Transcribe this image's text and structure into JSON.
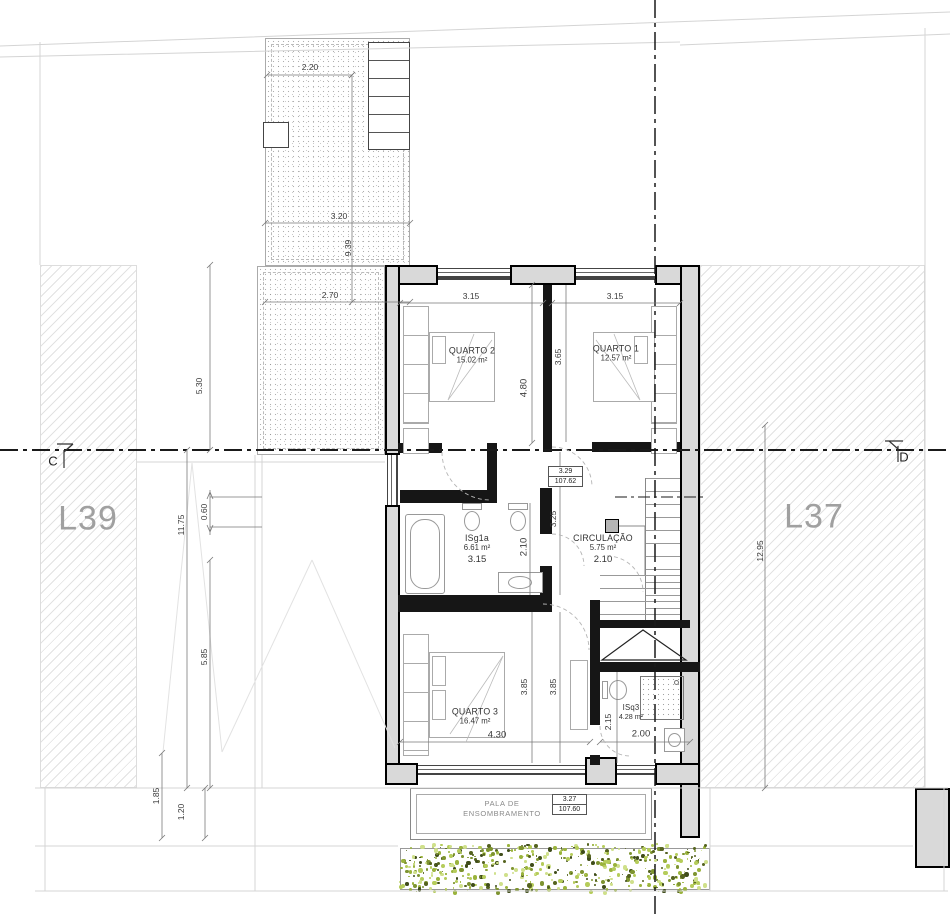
{
  "lots": {
    "left": "L39",
    "right": "L37"
  },
  "sections": {
    "left": "C",
    "right": "D"
  },
  "rooms": {
    "q2": {
      "name": "QUARTO 2",
      "area": "15.02 m²"
    },
    "q1": {
      "name": "QUARTO 1",
      "area": "12.57 m²"
    },
    "isg1a": {
      "name": "ISg1a",
      "area": "6.61 m²",
      "width": "3.15"
    },
    "circ": {
      "name": "CIRCULAÇÃO",
      "area": "5.75 m²",
      "width": "2.10"
    },
    "q3": {
      "name": "QUARTO 3",
      "area": "16.47 m²"
    },
    "isq3": {
      "name": "ISq3",
      "area": "4.28 m²"
    }
  },
  "levels": {
    "upper": {
      "rel": "3.29",
      "abs": "107.62"
    },
    "lower": {
      "rel": "3.27",
      "abs": "107.60"
    }
  },
  "shade": {
    "line1": "PALA DE",
    "line2": "ENSOMBRAMENTO"
  },
  "dims": {
    "roof_w1": "2.20",
    "roof_w2": "3.20",
    "roof_h": "9.39",
    "roof_w3": "2.70",
    "yard_a": "5.30",
    "yard_b": "11.75",
    "yard_c": "0.60",
    "yard_d": "5.85",
    "yard_e": "1.85",
    "yard_f": "1.20",
    "lot_right_h": "12.95",
    "q2_w": "3.15",
    "q1_w": "3.15",
    "q2_h": "4.80",
    "q1_h": "3.65",
    "hall_h": "3.25",
    "bath_h": "2.10",
    "q3_h1": "3.85",
    "q3_h2": "3.85",
    "q3_w": "4.30",
    "isq3_h": "2.15",
    "isq3_w": "2.00"
  },
  "colors": {
    "wall_fill": "#d9d9d9",
    "wall_line": "#000000",
    "lot_text": "#a0a0a0",
    "hedge": [
      "#9ab33c",
      "#b5cc5a",
      "#55631f",
      "#3f4c1a",
      "#cfe08a",
      "#7e9430"
    ]
  }
}
